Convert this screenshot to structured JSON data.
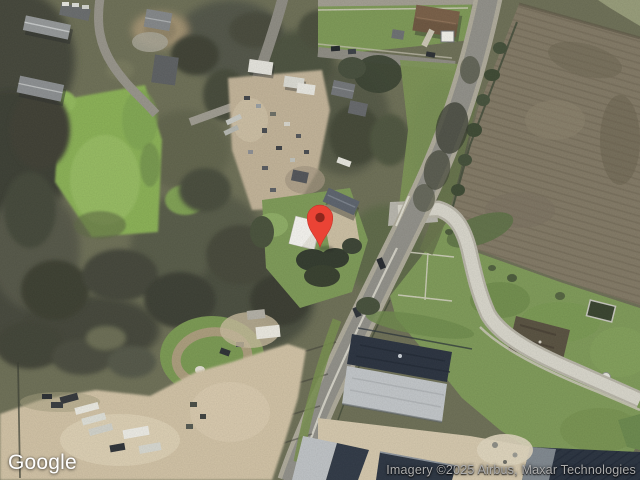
{
  "map": {
    "provider_logo": "Google",
    "attribution": "Imagery ©2025 Airbus, Maxar Technologies",
    "view_type": "satellite",
    "marker": {
      "shape": "google-maps-pin",
      "fill": "#EA4335",
      "dot": "#8E261D",
      "x": 320,
      "y": 247
    },
    "palette": {
      "tree_canopy_dark": "#42443a",
      "field_green_left": "#8bb257",
      "field_brown_right": "#837a66",
      "grass_bottom_right": "#7f9b59",
      "road_asphalt": "#92918a",
      "road_concrete_loop": "#d9d7cc",
      "dirt_lot": "#d2c3a6",
      "warehouse_roof_navy": "#2b3340",
      "warehouse_roof_gray": "#c3c7ca"
    }
  }
}
